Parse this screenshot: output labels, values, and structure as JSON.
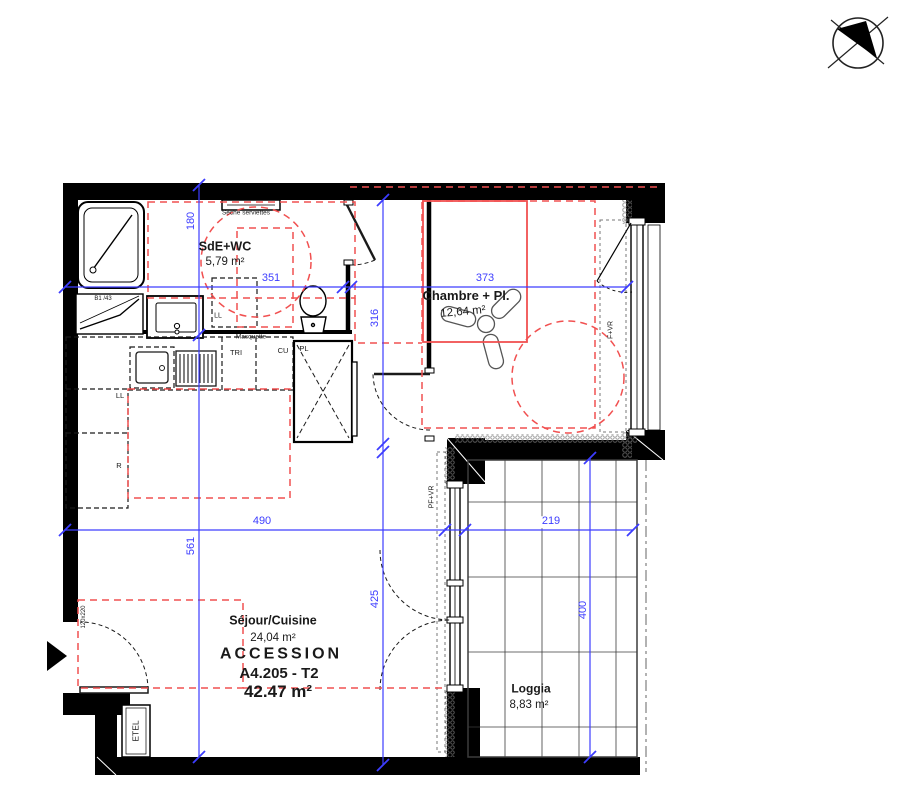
{
  "unit": {
    "program": "ACCESSION",
    "ref": "A4.205 - T2",
    "total_area": "42.47 m²"
  },
  "rooms": {
    "sde": {
      "name": "SdE+WC",
      "area": "5,79 m²"
    },
    "chambre": {
      "name": "Chambre + Pl.",
      "area": "12,64 m²"
    },
    "sejour": {
      "name": "Séjour/Cuisine",
      "area": "24,04 m²"
    },
    "loggia": {
      "name": "Loggia",
      "area": "8,83 m²"
    }
  },
  "dimensions": {
    "sde_width": "351",
    "chambre_width": "373",
    "sde_height": "180",
    "hall_height": "316",
    "left_height": "561",
    "sejour_width": "490",
    "sejour_height": "425",
    "loggia_width": "219",
    "loggia_height": "400"
  },
  "labels": {
    "towel_dryer": "Sèche serviettes",
    "washer_sde": "LL",
    "masque": "Masquette",
    "shower_ref": "B1 /43",
    "washer_kitchen": "LL",
    "fridge": "R",
    "sorting": "TRI",
    "kitchen_unit": "CU",
    "closet": "PL",
    "duct": "ETEL",
    "entry_door_size": "120x220",
    "window_bedroom": "F+VR",
    "window_living": "PF+VR"
  },
  "colors": {
    "dimension_blue": "#3d3dff",
    "zone_red": "#f15050",
    "wall_black": "#000000"
  }
}
